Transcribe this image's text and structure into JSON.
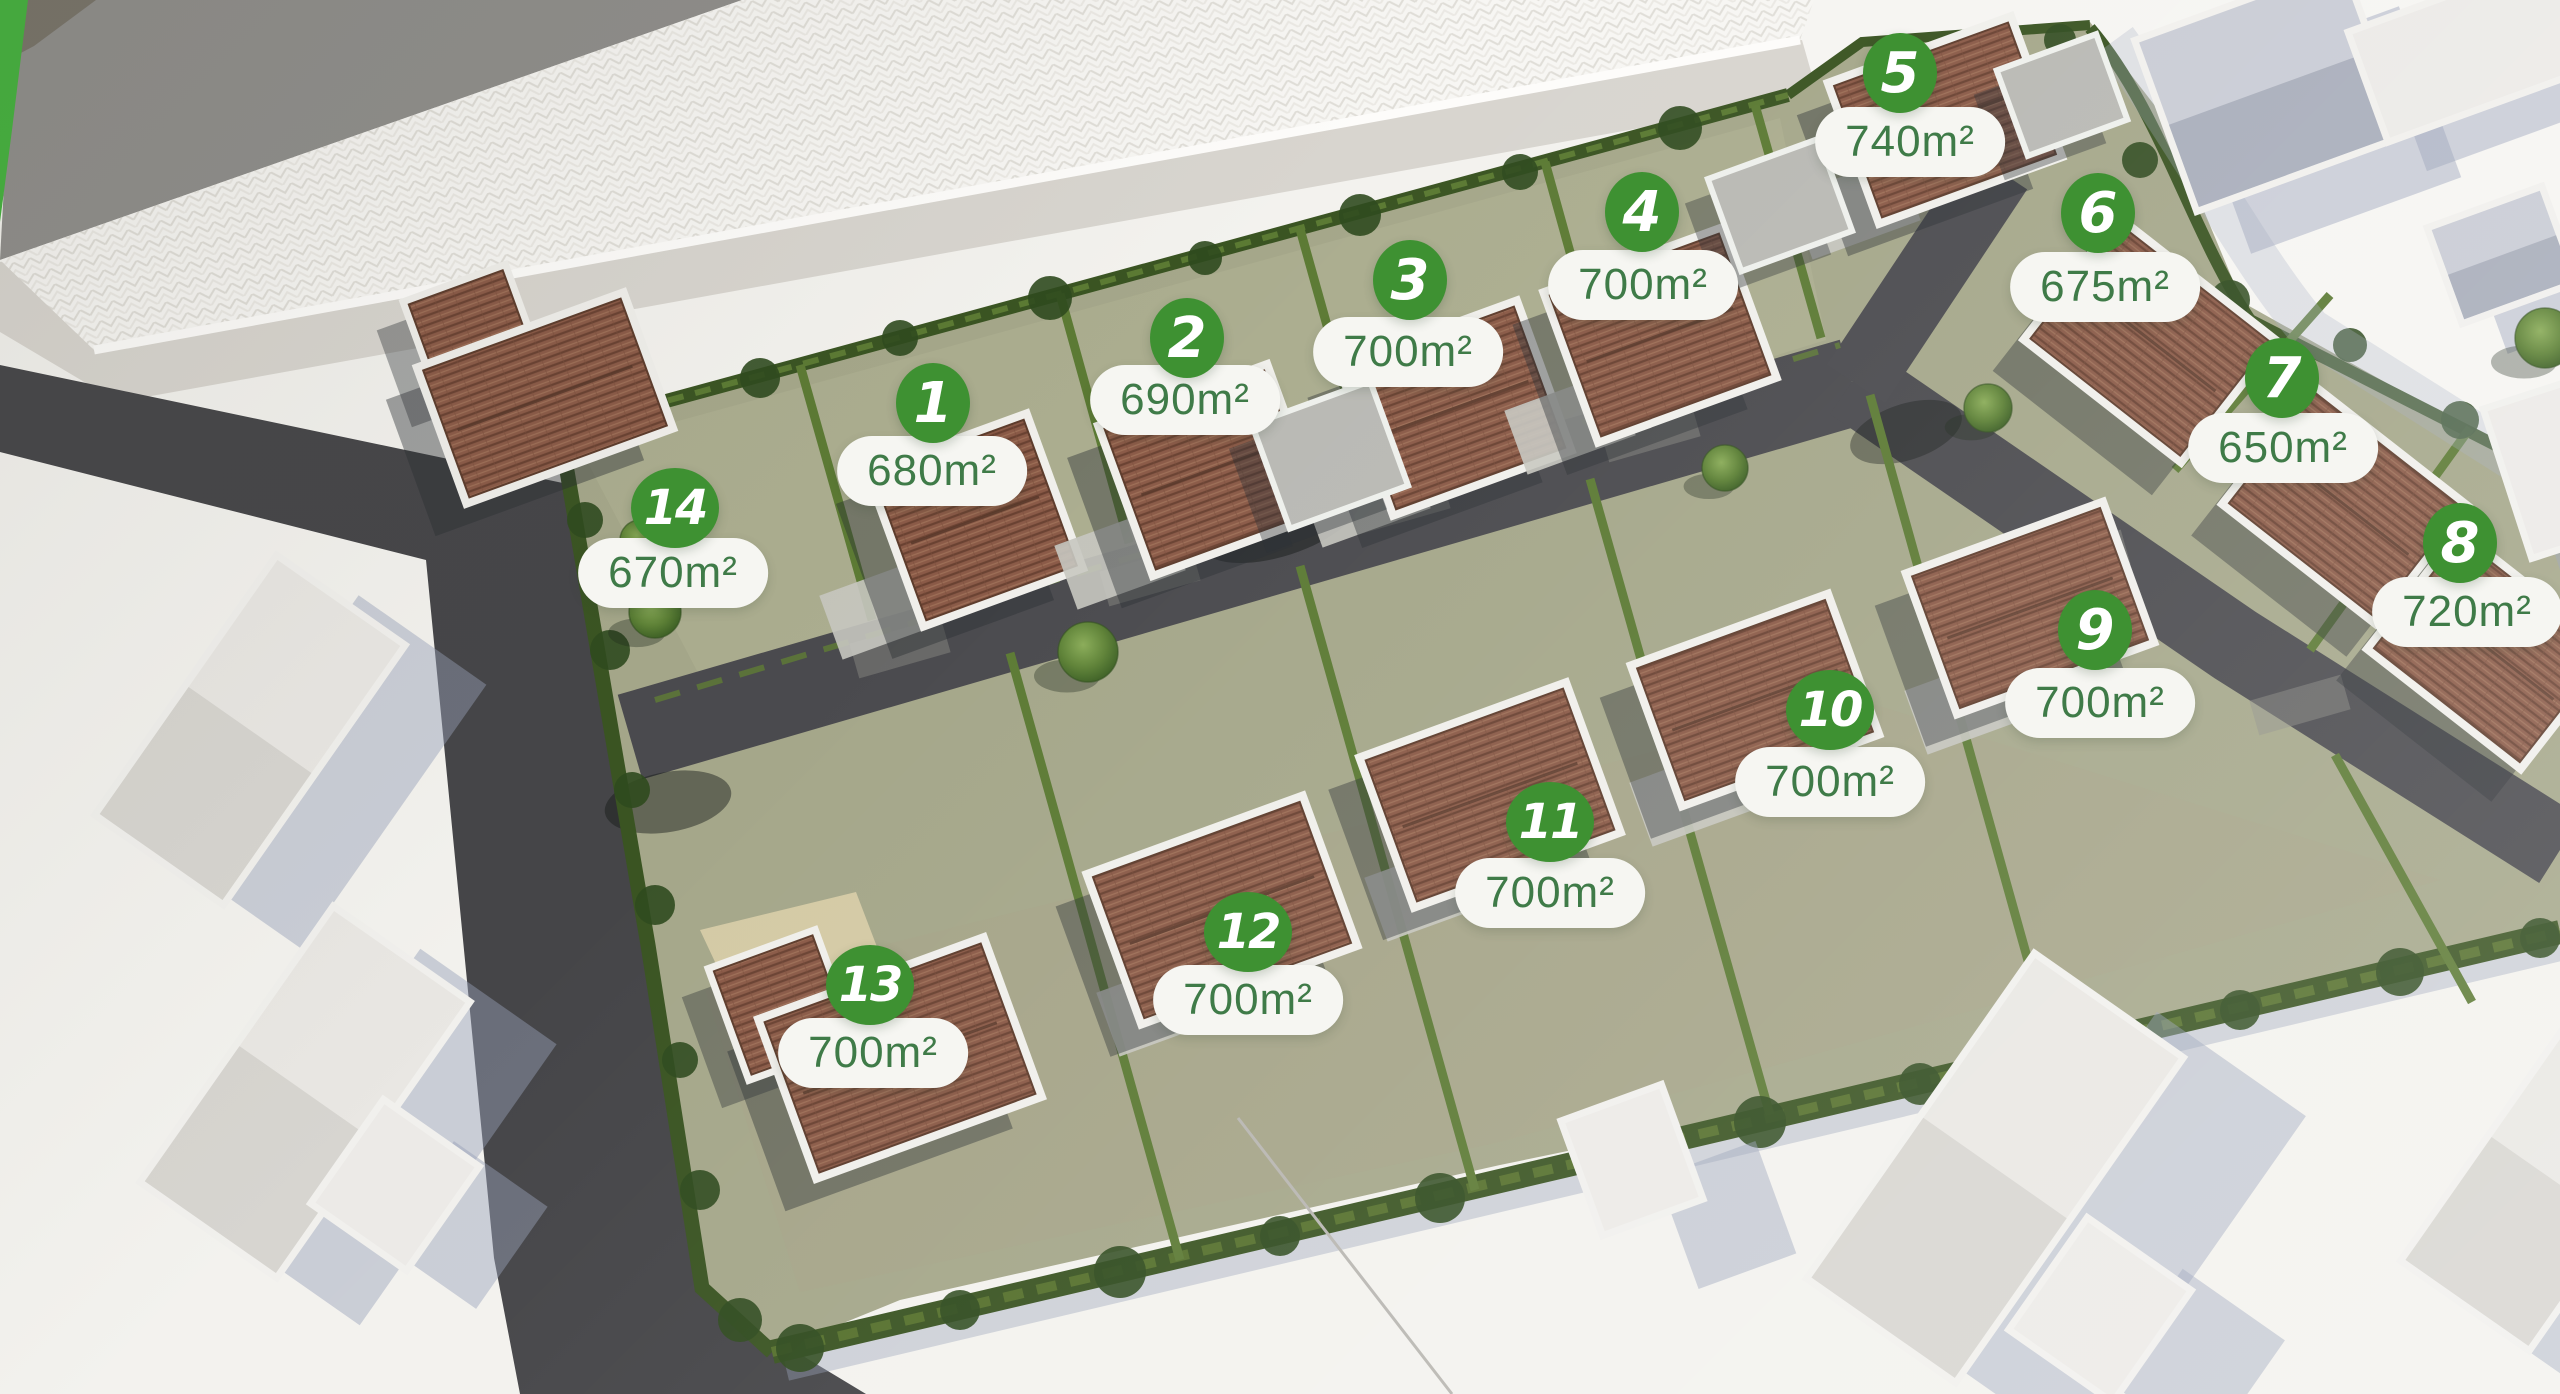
{
  "plan": {
    "kind": "residential-lot-site-plan",
    "area_unit": "m²",
    "lots": [
      {
        "number": "1",
        "area": "680m²",
        "badge": {
          "x": 933,
          "y": 403
        },
        "pill": {
          "x": 932,
          "y": 471
        }
      },
      {
        "number": "2",
        "area": "690m²",
        "badge": {
          "x": 1187,
          "y": 338
        },
        "pill": {
          "x": 1185,
          "y": 400
        }
      },
      {
        "number": "3",
        "area": "700m²",
        "badge": {
          "x": 1410,
          "y": 280
        },
        "pill": {
          "x": 1408,
          "y": 352
        }
      },
      {
        "number": "4",
        "area": "700m²",
        "badge": {
          "x": 1642,
          "y": 212
        },
        "pill": {
          "x": 1643,
          "y": 285
        }
      },
      {
        "number": "5",
        "area": "740m²",
        "badge": {
          "x": 1900,
          "y": 73
        },
        "pill": {
          "x": 1910,
          "y": 142
        }
      },
      {
        "number": "6",
        "area": "675m²",
        "badge": {
          "x": 2098,
          "y": 213
        },
        "pill": {
          "x": 2105,
          "y": 287
        }
      },
      {
        "number": "7",
        "area": "650m²",
        "badge": {
          "x": 2282,
          "y": 378
        },
        "pill": {
          "x": 2283,
          "y": 448
        }
      },
      {
        "number": "8",
        "area": "720m²",
        "badge": {
          "x": 2460,
          "y": 543
        },
        "pill": {
          "x": 2467,
          "y": 612
        }
      },
      {
        "number": "9",
        "area": "700m²",
        "badge": {
          "x": 2095,
          "y": 630
        },
        "pill": {
          "x": 2100,
          "y": 703
        }
      },
      {
        "number": "10",
        "area": "700m²",
        "badge": {
          "x": 1830,
          "y": 710
        },
        "pill": {
          "x": 1830,
          "y": 782
        }
      },
      {
        "number": "11",
        "area": "700m²",
        "badge": {
          "x": 1550,
          "y": 822
        },
        "pill": {
          "x": 1550,
          "y": 893
        }
      },
      {
        "number": "12",
        "area": "700m²",
        "badge": {
          "x": 1248,
          "y": 932
        },
        "pill": {
          "x": 1248,
          "y": 1000
        }
      },
      {
        "number": "13",
        "area": "700m²",
        "badge": {
          "x": 870,
          "y": 985
        },
        "pill": {
          "x": 873,
          "y": 1053
        }
      },
      {
        "number": "14",
        "area": "670m²",
        "badge": {
          "x": 675,
          "y": 508
        },
        "pill": {
          "x": 673,
          "y": 573
        }
      }
    ],
    "style": {
      "badge_bg": "#3e9132",
      "badge_text": "#ffffff",
      "pill_bg": "#f6f6f2",
      "pill_text": "#3f7b48",
      "grass": "#a5a78a",
      "hedge": "#3a5422",
      "road": "#48484c",
      "roof_tile": "#8a5a47"
    }
  }
}
